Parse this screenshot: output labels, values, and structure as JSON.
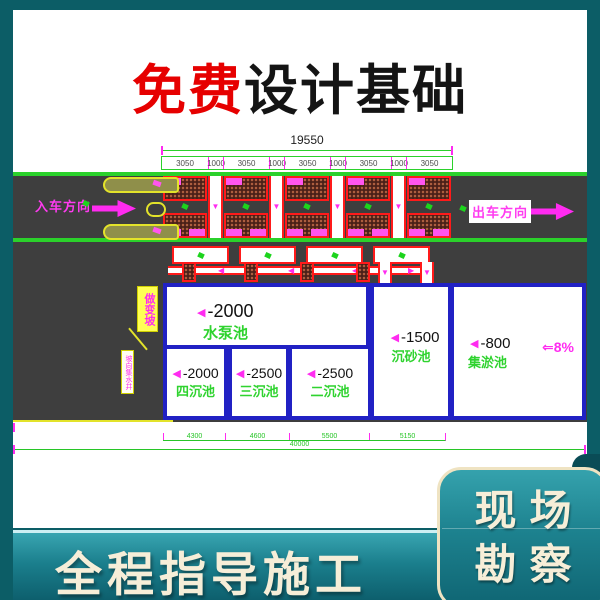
{
  "colors": {
    "teal_border": "#0c5d66",
    "card_bg": "#ffffff",
    "title_red": "#e60000",
    "title_black": "#141414",
    "road_gray": "#3e3e3e",
    "edge_green": "#2bd12b",
    "dim_green": "#27c527",
    "magenta": "#ff2bf0",
    "red_line": "#ff1a1a",
    "tank_blue": "#2121c4",
    "tank_name_green": "#2fd32f",
    "cream": "#f6eed8",
    "band_teal_top": "#39a5b1",
    "band_teal_bottom": "#0d5f6d"
  },
  "icons": {
    "depth_marker": "◀",
    "flow_down": "▼",
    "flow_left": "◀",
    "flow_right": "▶",
    "slope_arrow": "⇐"
  },
  "title": {
    "highlight": "免费",
    "rest": "设计基础"
  },
  "drawing": {
    "top_dim": {
      "total": "19550",
      "segments": [
        "3050",
        "1000",
        "3050",
        "1000",
        "3050",
        "1000",
        "3050",
        "1000",
        "3050"
      ]
    },
    "entry_label": "入车方向",
    "exit_label": "出车方向",
    "slope_tag": "做变坡",
    "slope_tag_note": "坡向集水井",
    "slope_label": "8%",
    "tanks": [
      {
        "depth": "-2000",
        "name": "水泵池"
      },
      {
        "depth": "-1500",
        "name": "沉砂池"
      },
      {
        "depth": "-800",
        "name": "集淤池"
      },
      {
        "depth": "-2000",
        "name": "四沉池"
      },
      {
        "depth": "-2500",
        "name": "三沉池"
      },
      {
        "depth": "-2500",
        "name": "二沉池"
      }
    ],
    "bottom_dim": {
      "segments": [
        "4300",
        "4600",
        "5500",
        "5150"
      ],
      "total": "40000"
    }
  },
  "footer": {
    "slogan": "全程指导施工"
  },
  "corner_card": {
    "line1": "现场",
    "line2": "勘察"
  }
}
